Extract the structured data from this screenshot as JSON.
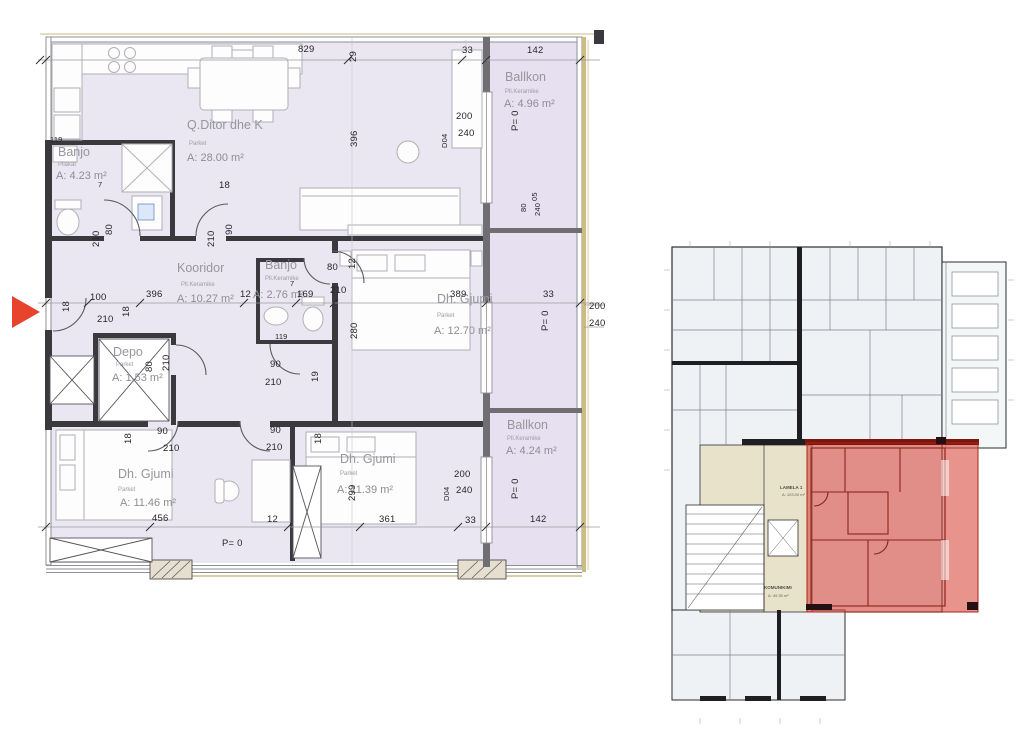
{
  "colors": {
    "room_fill": "#eae6f2",
    "balcony_fill": "#e6e0f1",
    "wall_dark": "#3a3a3e",
    "tan_edge": "#cdbb82",
    "label_gray": "#96969c",
    "entry_arrow_red": "#e8432c",
    "highlight_overlay_red": "#d94b3f",
    "overview_fill": "#eef2f4",
    "core_beige": "#e9e2cb"
  },
  "main_plan": {
    "rooms": [
      {
        "name": "Banjo",
        "floor": "Pllakat",
        "area": "A: 4.23 m²"
      },
      {
        "name": "Q.Ditor dhe K",
        "floor": "Parket",
        "area": "A: 28.00 m²"
      },
      {
        "name": "Ballkon",
        "floor": "Pll.Keramike",
        "area": "A: 4.96 m²"
      },
      {
        "name": "Kooridor",
        "floor": "Pll.Keramike",
        "area": "A: 10.27 m²"
      },
      {
        "name": "Banjo",
        "floor": "Pll.Keramike",
        "area": "A: 2.76 m²"
      },
      {
        "name": "Dh. Gjumi",
        "floor": "Parket",
        "area": "A: 12.70 m²"
      },
      {
        "name": "Depo",
        "floor": "Parket",
        "area": "A: 1.53 m²"
      },
      {
        "name": "Dh. Gjumi",
        "floor": "Parket",
        "area": "A: 11.46 m²"
      },
      {
        "name": "Dh. Gjumi",
        "floor": "Parket",
        "area": "A: 11.39 m²"
      },
      {
        "name": "Ballkon",
        "floor": "Pll.Keramike",
        "area": "A: 4.24 m²"
      }
    ],
    "dims": {
      "v829": "829",
      "v29": "29",
      "v33": "33",
      "v142": "142",
      "v119": "119",
      "v7": "7",
      "v18": "18",
      "v19": "19",
      "v80": "80",
      "v90": "90",
      "v100": "100",
      "v210": "210",
      "v396": "396",
      "v12": "12",
      "v169": "169",
      "v389": "389",
      "v280": "280",
      "v299": "299",
      "v200": "200",
      "v240": "240",
      "v456": "456",
      "v361": "361",
      "v05": "05",
      "d04": "D04",
      "p0": "P= 0"
    }
  },
  "overview": {
    "core_label": "LAMELA 1",
    "core_area": "A: 103.00 m²",
    "corridor_label": "KOMUNIKIMI",
    "corridor_area": "A: 49.30 m²"
  }
}
